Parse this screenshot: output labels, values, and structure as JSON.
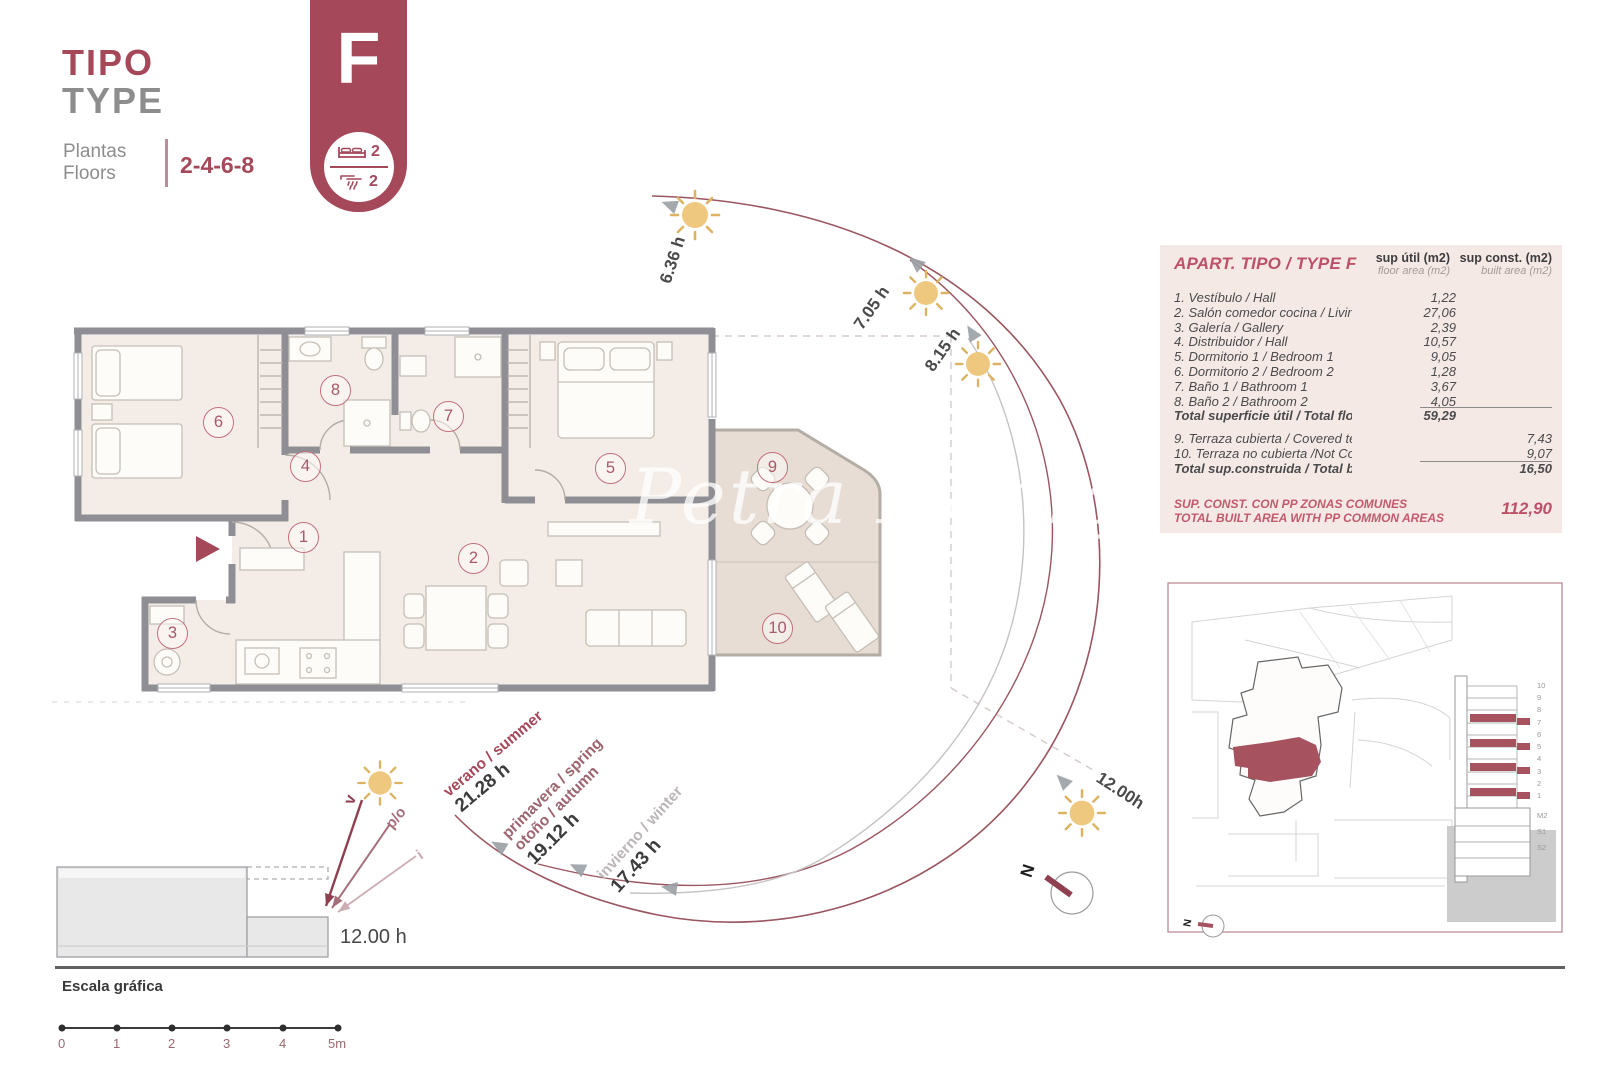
{
  "header": {
    "title_primary": "TIPO",
    "title_secondary": "TYPE",
    "floors_label_line1": "Plantas",
    "floors_label_line2": "Floors",
    "floors_value": "2-4-6-8"
  },
  "badge": {
    "letter": "F",
    "bedrooms_count": "2",
    "bathrooms_count": "2"
  },
  "area_table": {
    "title": "APART. TIPO / TYPE F",
    "col_floor_line1": "sup útil (m2)",
    "col_floor_line2": "floor area (m2)",
    "col_built_line1": "sup const. (m2)",
    "col_built_line2": "built area (m2)",
    "rows": [
      {
        "label": "1. Vestíbulo / Hall",
        "floor_area": "1,22",
        "built_area": ""
      },
      {
        "label": "2. Salón comedor cocina / Living dinning kitchen",
        "floor_area": "27,06",
        "built_area": ""
      },
      {
        "label": "3. Galería / Gallery",
        "floor_area": "2,39",
        "built_area": ""
      },
      {
        "label": "4. Distribuidor / Hall",
        "floor_area": "10,57",
        "built_area": ""
      },
      {
        "label": "5. Dormitorio 1 / Bedroom 1",
        "floor_area": "9,05",
        "built_area": ""
      },
      {
        "label": "6. Dormitorio 2 / Bedroom 2",
        "floor_area": "1,28",
        "built_area": ""
      },
      {
        "label": "7. Baño 1 / Bathroom 1",
        "floor_area": "3,67",
        "built_area": ""
      },
      {
        "label": "8. Baño 2 / Bathroom 2",
        "floor_area": "4,05",
        "built_area": ""
      }
    ],
    "total_floor": {
      "label": "Total superficie útil / Total floor area",
      "value": "59,29"
    },
    "terrace_rows": [
      {
        "label": "9. Terraza cubierta / Covered terrace",
        "value": "7,43"
      },
      {
        "label": "10. Terraza no cubierta /Not Covered terrace",
        "value": "9,07"
      }
    ],
    "total_built": {
      "label": "Total sup.construida / Total built area",
      "value": "16,50"
    },
    "common_areas": {
      "label_line1": "SUP. CONST. CON PP ZONAS COMUNES",
      "label_line2": "TOTAL BUILT AREA WITH PP COMMON AREAS",
      "value": "112,90"
    }
  },
  "floor_plan": {
    "room_numbers": [
      "1",
      "2",
      "3",
      "4",
      "5",
      "6",
      "7",
      "8",
      "9",
      "10"
    ]
  },
  "sun_hours": {
    "h1": "6.36 h",
    "h2": "7.05 h",
    "h3": "8.15 h",
    "noon": "12.00h"
  },
  "seasons": {
    "summer": {
      "name": "verano / summer",
      "hours": "21.28 h"
    },
    "spring_autumn": {
      "name1": "primavera / spring",
      "name2": "otoño / autumn",
      "hours": "19.12 h"
    },
    "winter": {
      "name": "invierno / winter",
      "hours": "17.43 h"
    }
  },
  "section": {
    "ray_summer": "v",
    "ray_spring_autumn": "p/o",
    "ray_winter": "i",
    "noon_label": "12.00 h"
  },
  "scale_bar": {
    "title": "Escala gráfica",
    "ticks": [
      "0",
      "1",
      "2",
      "3",
      "4",
      "5m"
    ]
  },
  "site_panel": {
    "elevation_floor_labels": [
      "10",
      "9",
      "8",
      "7",
      "6",
      "5",
      "4",
      "3",
      "2",
      "1",
      "M2",
      "S1",
      "S2"
    ],
    "compass_letter": "N"
  },
  "compass_letter": "N",
  "watermark": "Petra Honig",
  "colors": {
    "accent": "#a5485a",
    "accent_soft": "#c1707c",
    "table_bg": "#f4e9e5",
    "wall": "#8e8e94",
    "room_fill": "#f4ede7",
    "terrace_fill": "#e7ddd4",
    "sun_fill": "#eec87f",
    "arc": "#9b5560",
    "gray_text": "#8d8d8d",
    "dark_text": "#4a4a4c"
  }
}
